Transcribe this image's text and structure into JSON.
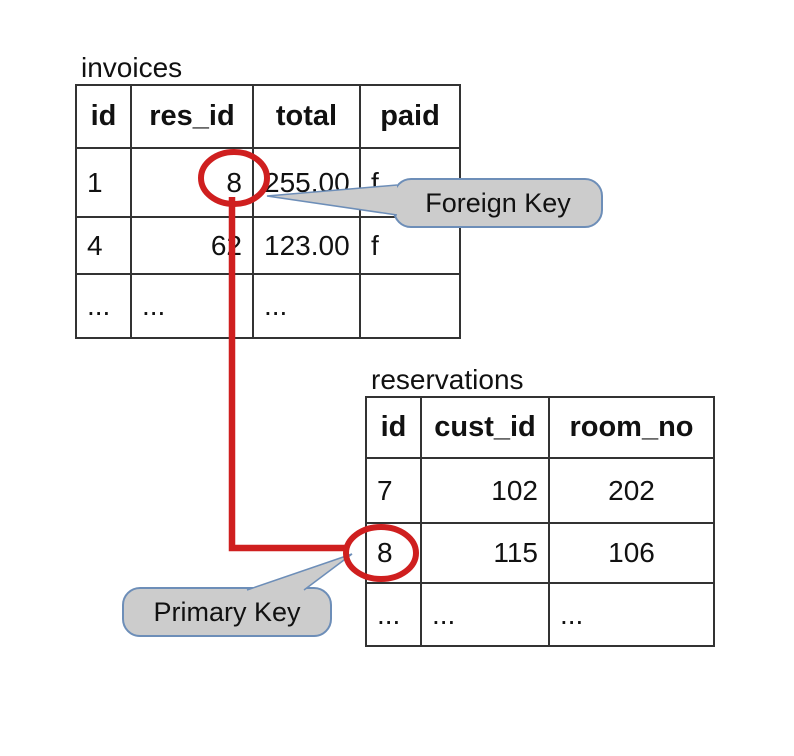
{
  "colors": {
    "red": "#cf1f1f",
    "callout_fill": "#cccccc",
    "callout_border": "#6d8eb8",
    "table_border": "#333333",
    "text": "#111111"
  },
  "invoices": {
    "title": "invoices",
    "headers": [
      "id",
      "res_id",
      "total",
      "paid"
    ],
    "rows": [
      [
        "1",
        "8",
        "255.00",
        "f"
      ],
      [
        "4",
        "62",
        "123.00",
        "f"
      ],
      [
        "...",
        "...",
        "...",
        ""
      ]
    ]
  },
  "reservations": {
    "title": "reservations",
    "headers": [
      "id",
      "cust_id",
      "room_no"
    ],
    "rows": [
      [
        "7",
        "102",
        "202"
      ],
      [
        "8",
        "115",
        "106"
      ],
      [
        "...",
        "...",
        "..."
      ]
    ]
  },
  "callouts": {
    "foreign_key": "Foreign Key",
    "primary_key": "Primary Key"
  }
}
